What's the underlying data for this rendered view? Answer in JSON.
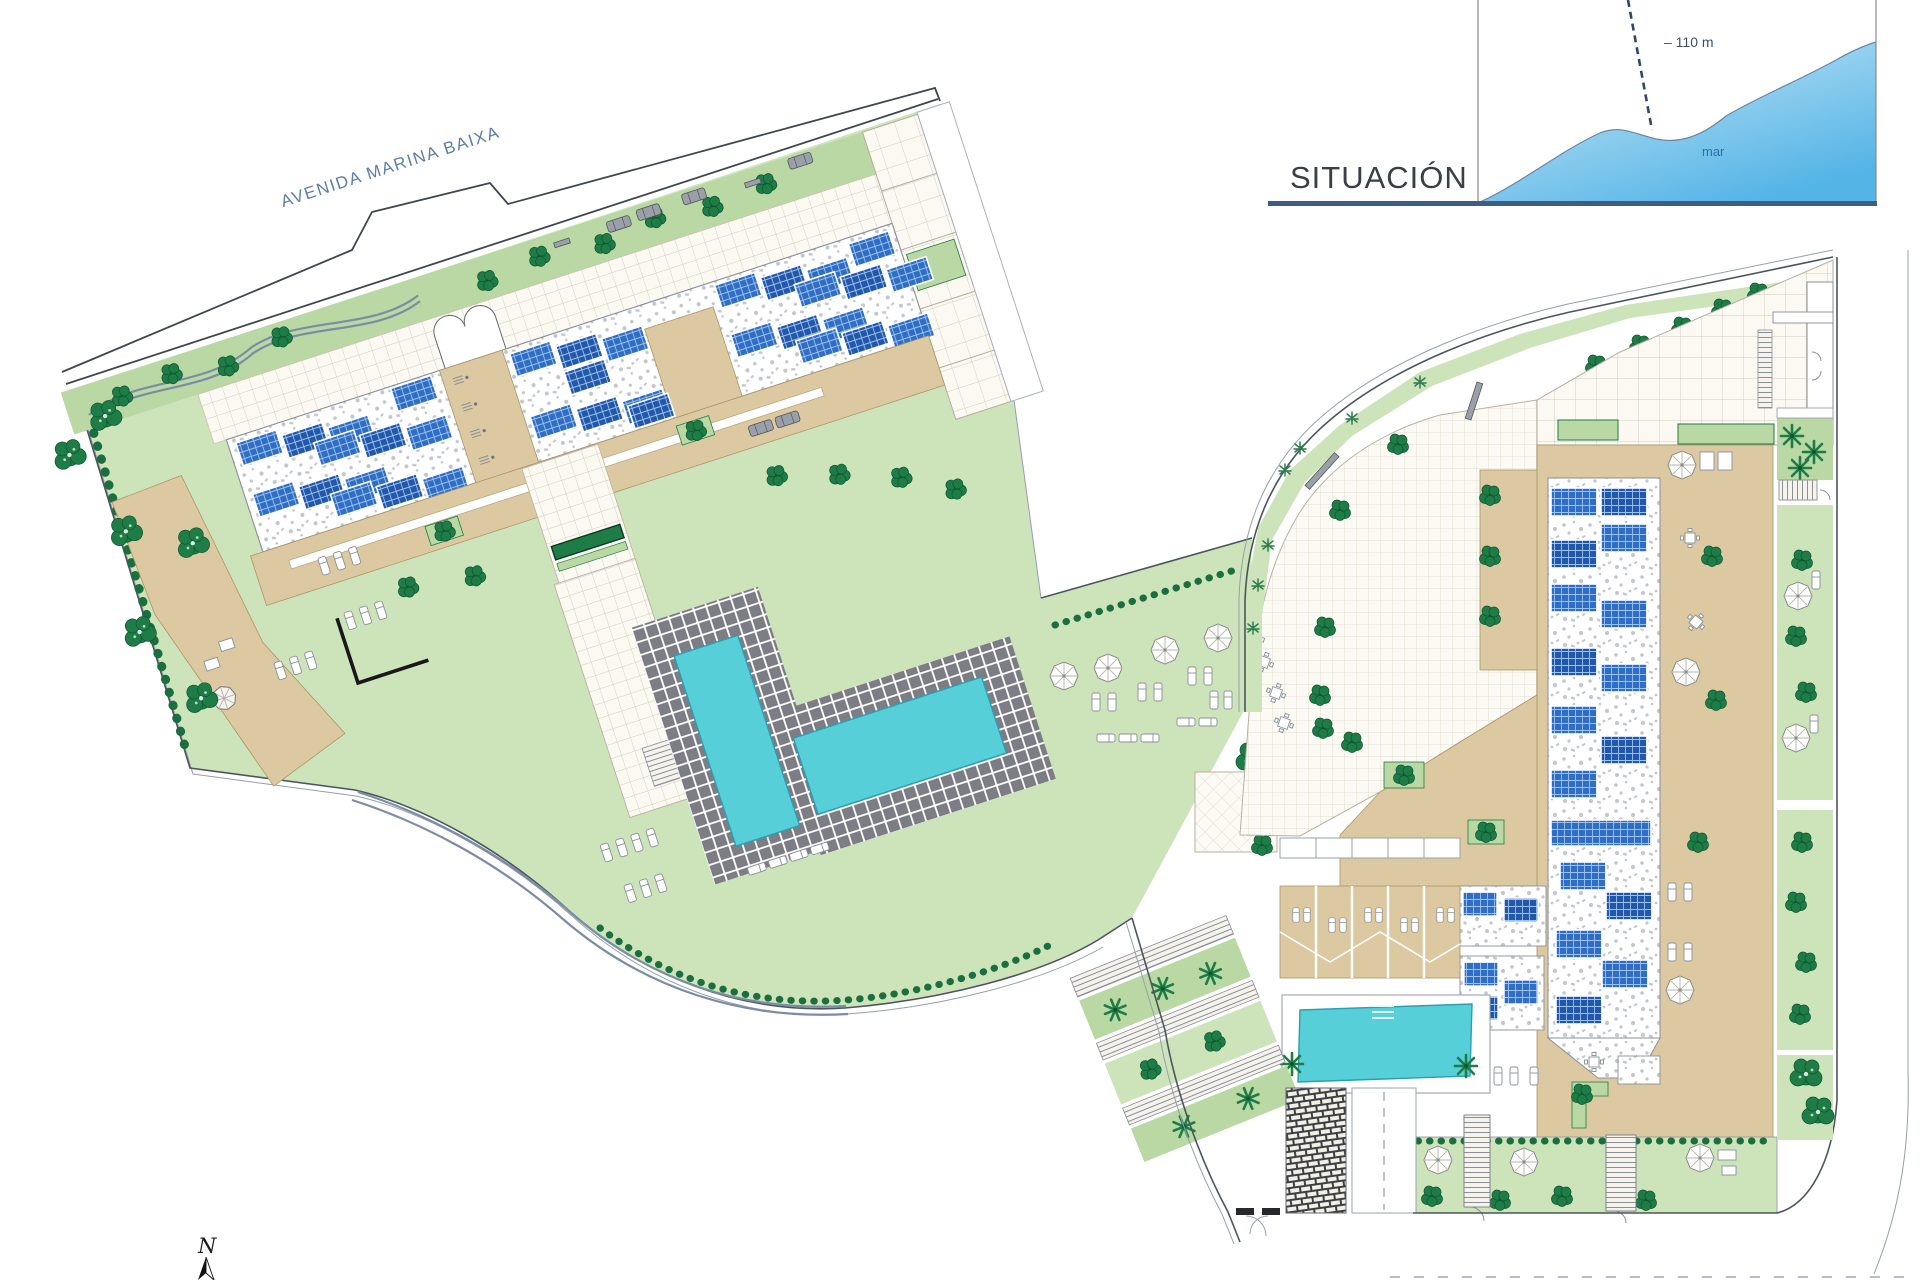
{
  "plan": {
    "street_label": "AVENIDA MARINA BAIXA",
    "north_label": "N"
  },
  "inset": {
    "title": "SITUACIÓN",
    "distance_label": "– 110 m",
    "sea_label": "mar"
  },
  "icons": {
    "tree-icon": "dark-green circle cluster",
    "palm-icon": "radiating fronds star",
    "parasol-icon": "white octagon with spokes",
    "gazebo-icon": "octagonal canopy",
    "lounger-icon": "small white rounded rectangle",
    "table-icon": "square table with four chairs",
    "car-icon": "gray rounded rectangle",
    "plant-icon": "small crossed-stem shrub",
    "bench-icon": "short gray bar",
    "stairs-icon": "parallel rungs band",
    "north-arrow-icon": "half-shaded compass needle",
    "gate-icon": "dark bars with swing arc"
  },
  "colors": {
    "paper": "#ffffff",
    "lawn": "#cde3ba",
    "lawn_dark": "#b9d8a4",
    "tree": "#1e7c46",
    "tree_dark": "#0f5530",
    "hedge": "#1b6e3e",
    "beige": "#ddc9a1",
    "beige_line": "#ab9668",
    "panel_blue": "#2f6ec4",
    "panel_blue_dark": "#2257aa",
    "paver_gray": "#7d7d85",
    "pool_teal": "#57cfd8",
    "pool_edge": "#2a9fb0",
    "path_gray": "#7b8da4",
    "boundary": "#4c555f",
    "road_dark": "#3f464e",
    "sea_light": "#cfeaf8",
    "sea_deep": "#54b4e6",
    "sea_text": "#2f6fb0",
    "street_text": "#5d7ea6",
    "title_text": "#3a3f45",
    "underline_blue": "#3f5d82"
  }
}
